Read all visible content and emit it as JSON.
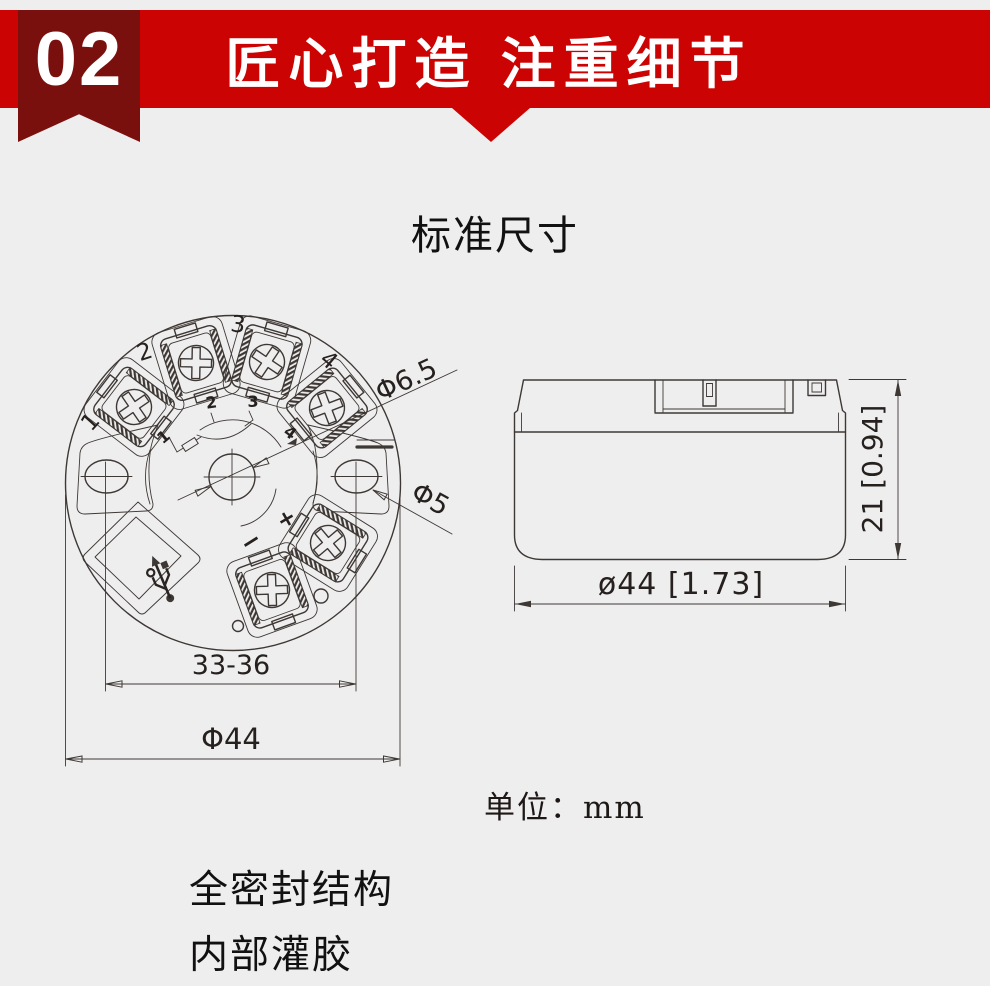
{
  "page": {
    "bg_color": "#efeeee"
  },
  "header": {
    "badge_number": "02",
    "banner_title": "匠心打造 注重细节",
    "banner_color": "#cb0302",
    "ribbon_color": "#7a100e"
  },
  "section": {
    "title": "标准尺寸"
  },
  "top_view": {
    "terminal_labels": [
      "1",
      "2",
      "3",
      "4"
    ],
    "schematic_labels": [
      "1",
      "2",
      "3",
      "4"
    ],
    "polarity_plus": "+",
    "polarity_minus": "−",
    "dim_center_hole": "Φ6.5",
    "dim_side_hole": "Φ5",
    "dim_hole_span": "33-36",
    "dim_outer_diameter": "Φ44"
  },
  "side_view": {
    "dim_height": "21 [0.94]",
    "dim_width": "ø44 [1.73]"
  },
  "notes": {
    "unit_label": "单位：mm",
    "feature_line1": "全密封结构",
    "feature_line2": "内部灌胶"
  }
}
